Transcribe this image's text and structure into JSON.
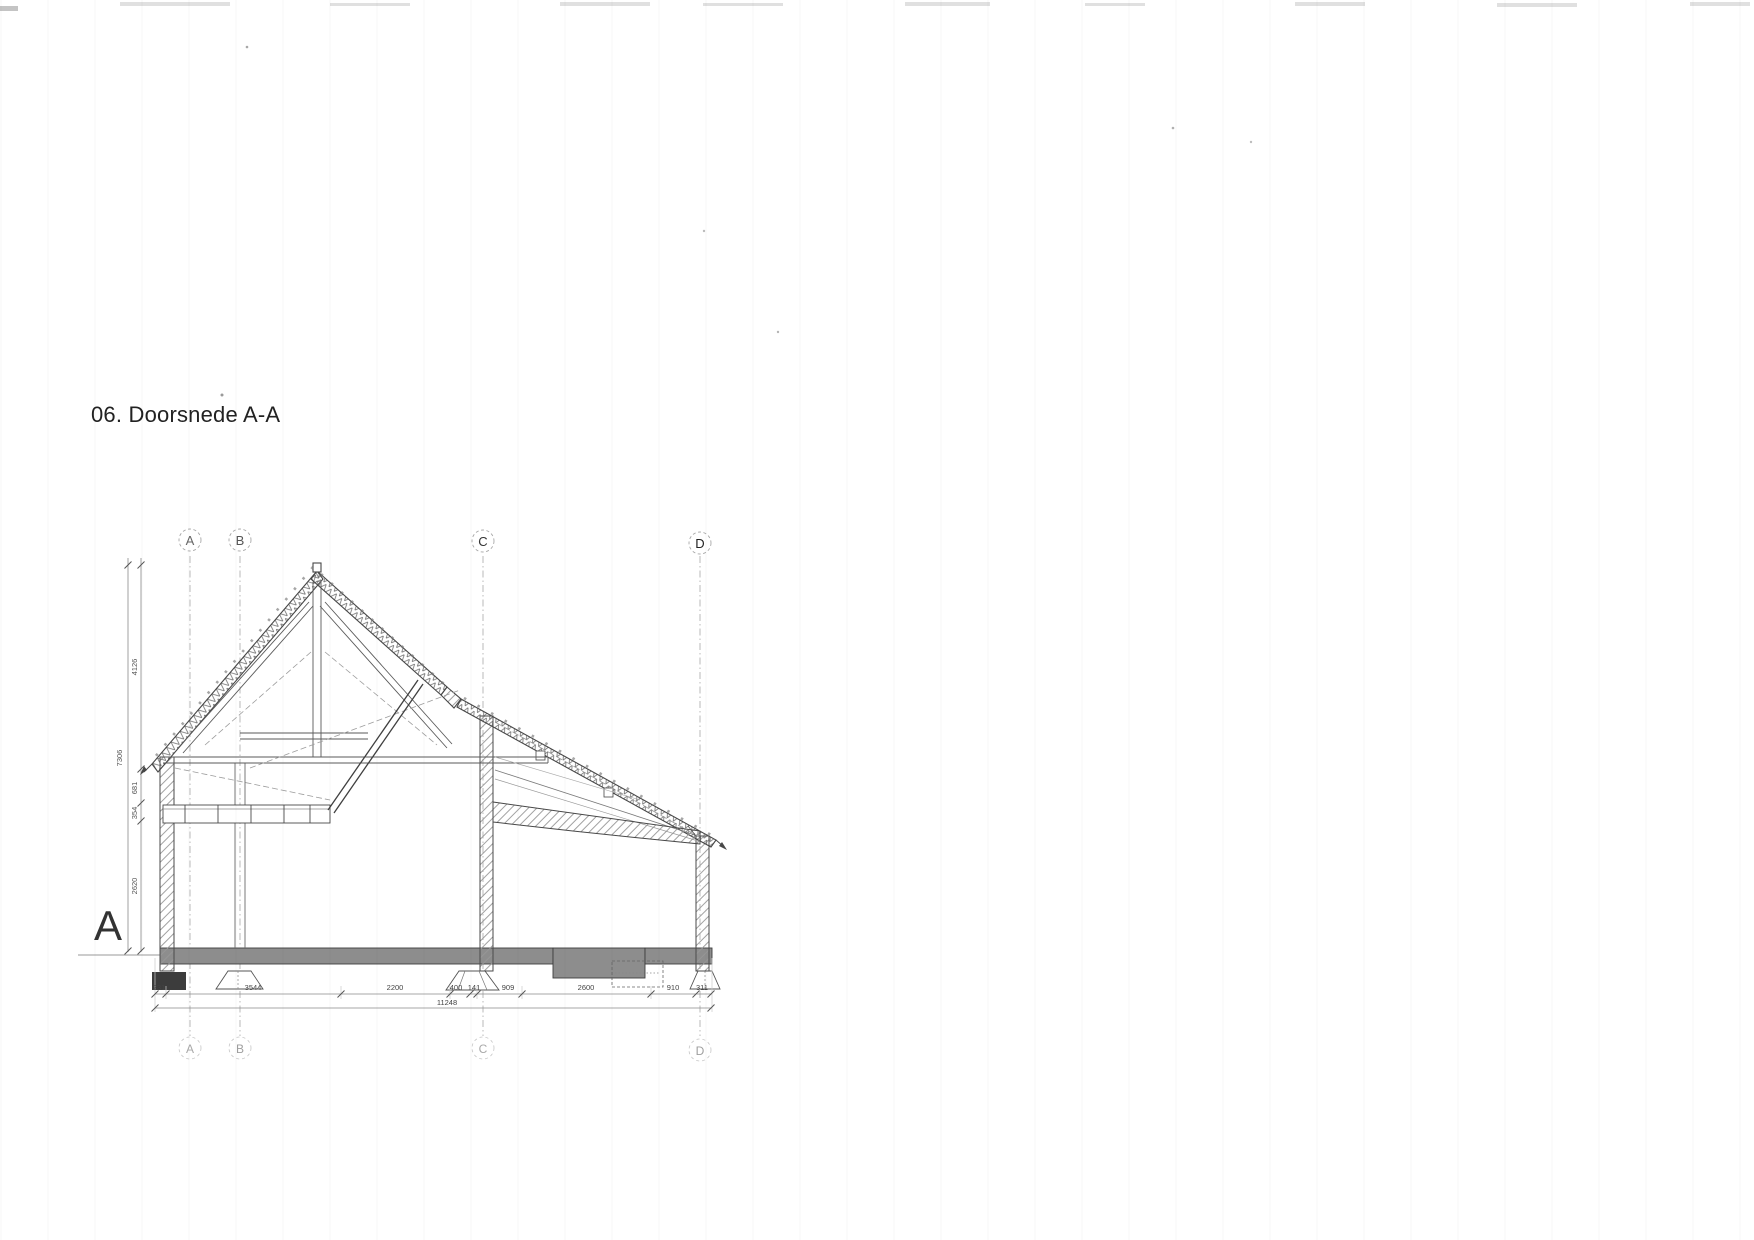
{
  "page": {
    "title": "06. Doorsnede A-A",
    "section_letter": "A"
  },
  "grid": {
    "labels": [
      "A",
      "B",
      "C",
      "D"
    ]
  },
  "dims": {
    "vertical": {
      "total": "7306",
      "segments": [
        "4126",
        "681",
        "354",
        "2620"
      ]
    },
    "horizontal": {
      "total": "11248",
      "segments": [
        "231",
        "3544",
        "2200",
        "400",
        "141",
        "909",
        "2600",
        "910",
        "311"
      ]
    }
  },
  "colors": {
    "ink": "#4a4a4a",
    "paper": "#ffffff",
    "grid_line": "#b3b3b3",
    "dim_line": "#666666",
    "slab": "#8d8d8d",
    "footing": "#3c3c3c"
  }
}
